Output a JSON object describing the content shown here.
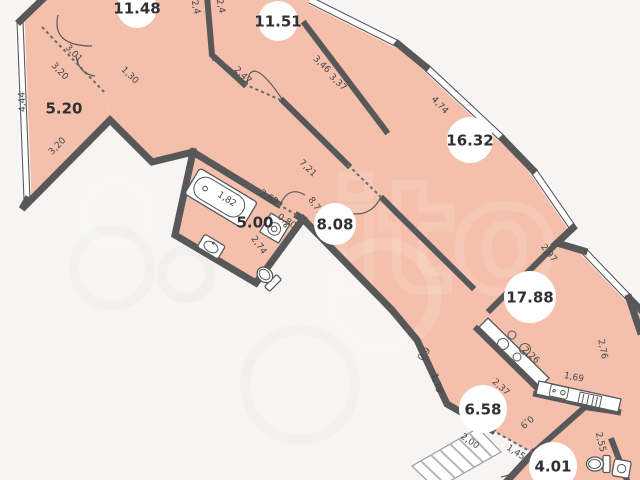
{
  "title": "Apartment floor plan",
  "watermark": {
    "letters": "ito"
  },
  "colors": {
    "room_fill": "#f4c0ab",
    "wall": "#58585a",
    "background": "#f6f5f3",
    "dimension_text": "#45454a",
    "area_text": "#303034",
    "label_disc": "#ffffff"
  },
  "floorplan": {
    "units_note": "areas in m2 with dot separator, linear dims in m with comma separator",
    "area_labels": [
      {
        "text": "11.48",
        "x": 137,
        "y": 8,
        "r": 20,
        "disc": true
      },
      {
        "text": "11.51",
        "x": 278,
        "y": 21,
        "r": 20,
        "disc": true
      },
      {
        "text": "16.32",
        "x": 470,
        "y": 140,
        "r": 23,
        "disc": true
      },
      {
        "text": "17.88",
        "x": 530,
        "y": 297,
        "r": 26,
        "disc": true
      },
      {
        "text": "8.08",
        "x": 335,
        "y": 224,
        "r": 21,
        "disc": true
      },
      {
        "text": "5.00",
        "x": 255,
        "y": 222,
        "r": 0,
        "disc": false
      },
      {
        "text": "5.20",
        "x": 64,
        "y": 108,
        "r": 0,
        "disc": false
      },
      {
        "text": "6.58",
        "x": 483,
        "y": 409,
        "r": 24,
        "disc": true
      },
      {
        "text": "4.01",
        "x": 553,
        "y": 466,
        "r": 24,
        "disc": true
      }
    ],
    "dimension_labels": [
      {
        "text": "4,44",
        "x": 22,
        "y": 102,
        "rot": -92
      },
      {
        "text": "3,01",
        "x": 74,
        "y": 53,
        "rot": 46
      },
      {
        "text": "3,20",
        "x": 60,
        "y": 71,
        "rot": 46
      },
      {
        "text": "3,20",
        "x": 57,
        "y": 146,
        "rot": -46
      },
      {
        "text": "1,30",
        "x": 130,
        "y": 75,
        "rot": 44
      },
      {
        "text": "2,4",
        "x": 196,
        "y": 7,
        "rot": 78
      },
      {
        "text": "2,4",
        "x": 221,
        "y": 6,
        "rot": 78
      },
      {
        "text": "2,47",
        "x": 243,
        "y": 75,
        "rot": 44
      },
      {
        "text": "3,46",
        "x": 322,
        "y": 64,
        "rot": 44
      },
      {
        "text": "3,37",
        "x": 338,
        "y": 82,
        "rot": 44
      },
      {
        "text": "4,74",
        "x": 440,
        "y": 105,
        "rot": 47
      },
      {
        "text": "2,97",
        "x": 549,
        "y": 253,
        "rot": 52
      },
      {
        "text": "2,76",
        "x": 603,
        "y": 349,
        "rot": 79
      },
      {
        "text": "7,21",
        "x": 308,
        "y": 168,
        "rot": 44
      },
      {
        "text": "8,71",
        "x": 316,
        "y": 206,
        "rot": 55
      },
      {
        "text": "2,62",
        "x": 269,
        "y": 197,
        "rot": 33
      },
      {
        "text": "0,80",
        "x": 287,
        "y": 221,
        "rot": 33
      },
      {
        "text": "1,82",
        "x": 227,
        "y": 199,
        "rot": 33
      },
      {
        "text": "2,74",
        "x": 259,
        "y": 245,
        "rot": 55
      },
      {
        "text": "2,26",
        "x": 531,
        "y": 355,
        "rot": 43
      },
      {
        "text": "2,37",
        "x": 501,
        "y": 387,
        "rot": 43
      },
      {
        "text": "1,69",
        "x": 574,
        "y": 377,
        "rot": 11
      },
      {
        "text": "0,9",
        "x": 424,
        "y": 354,
        "rot": -48
      },
      {
        "text": "1,79",
        "x": 437,
        "y": 383,
        "rot": 74
      },
      {
        "text": "2,00",
        "x": 470,
        "y": 441,
        "rot": 34
      },
      {
        "text": "0,9",
        "x": 527,
        "y": 422,
        "rot": 138
      },
      {
        "text": "1,45",
        "x": 516,
        "y": 452,
        "rot": 33
      },
      {
        "text": "2,55",
        "x": 601,
        "y": 442,
        "rot": 77
      }
    ],
    "fixtures": [
      "bathtub",
      "bathroom-sink",
      "toilet",
      "washing-machine",
      "stove",
      "kitchen-sink",
      "dish-drainer",
      "toilet-2",
      "corner-sink"
    ]
  }
}
